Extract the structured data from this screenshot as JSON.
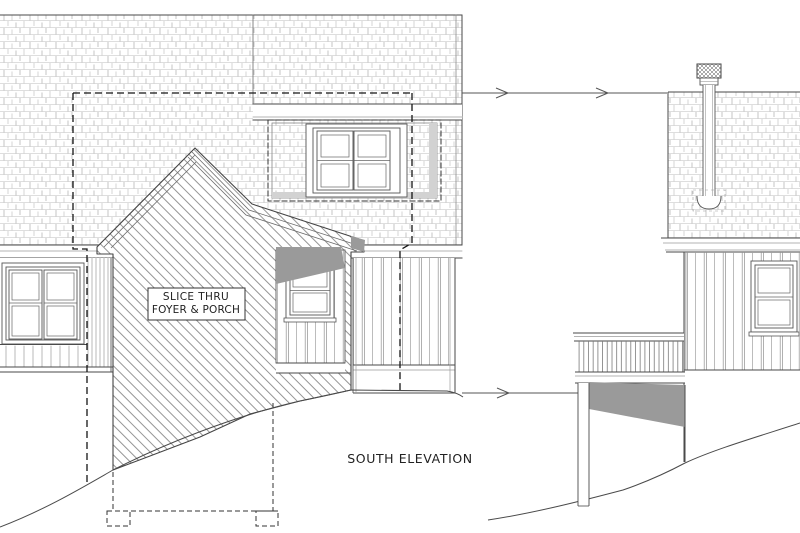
{
  "drawing": {
    "type": "architectural-elevation",
    "title": "SOUTH ELEVATION",
    "slice_label": {
      "line1": "SLICE THRU",
      "line2": "FOYER & PORCH"
    },
    "colors": {
      "paper": "#ffffff",
      "ink": "#4a4a4a",
      "light_line": "#b0b0b0",
      "section_gray": "#9a9a9a",
      "panel_shade": "#d2d2d2",
      "dashed_line": "#151515"
    }
  }
}
